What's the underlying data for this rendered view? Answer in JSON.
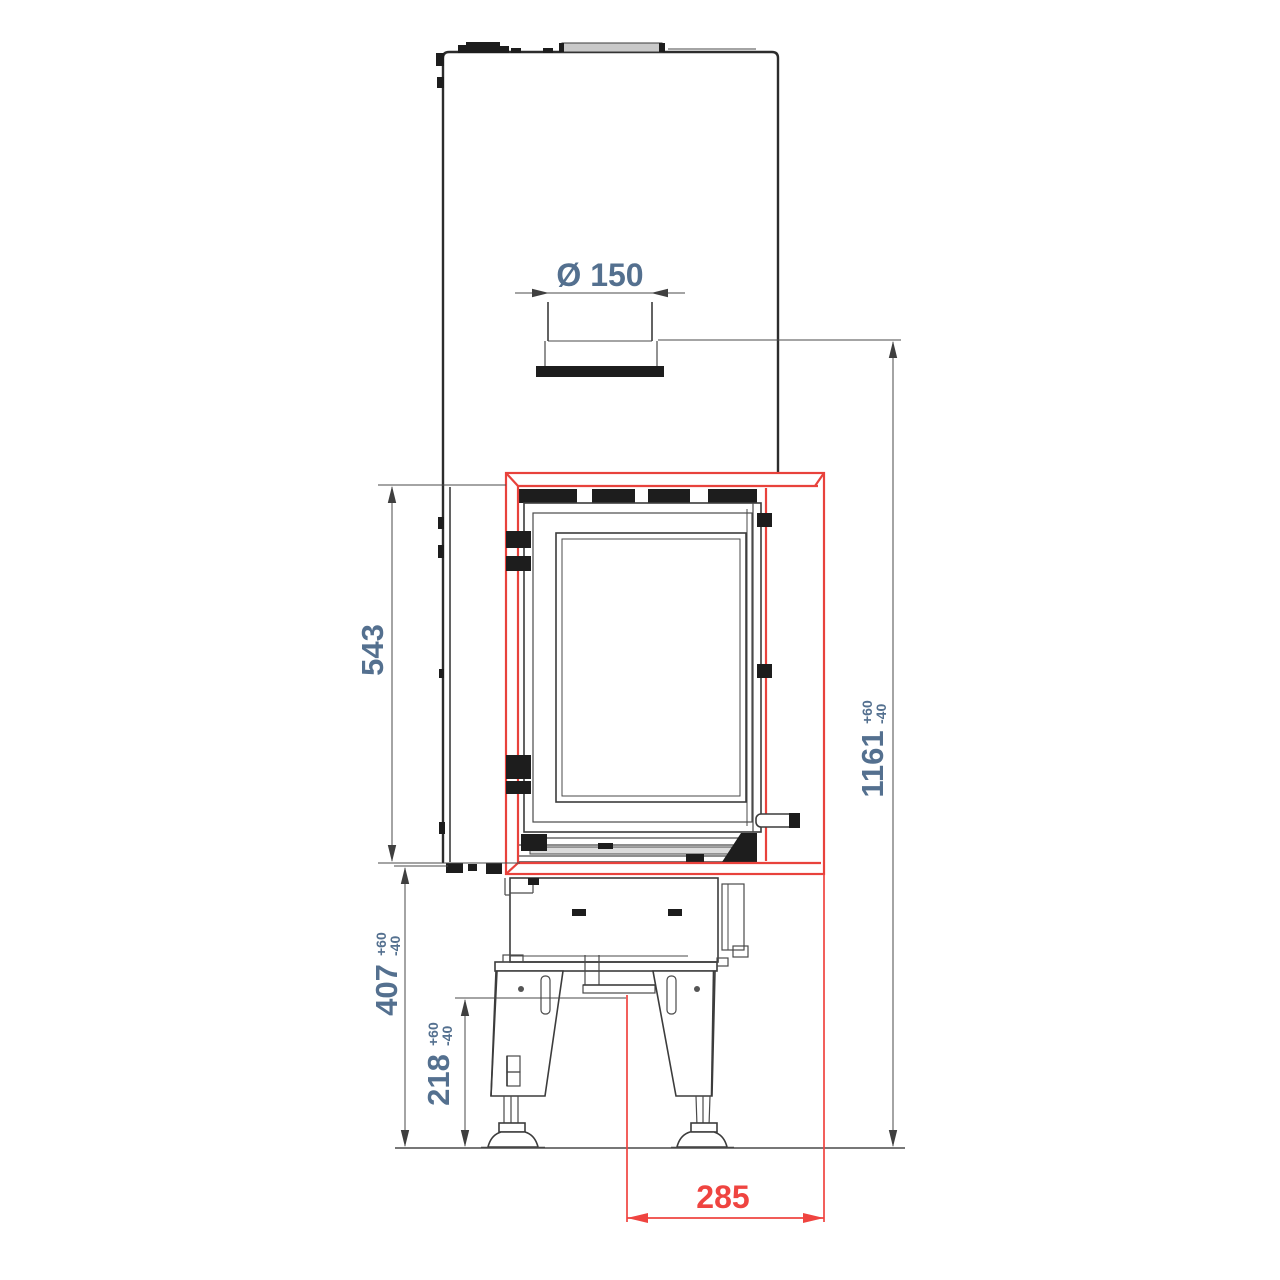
{
  "dims": {
    "flue_diameter": "Ø 150",
    "firebox_height": "543",
    "total_height": "1161",
    "total_height_tol_plus": "+60",
    "total_height_tol_minus": "-40",
    "base_height": "407",
    "base_height_tol_plus": "+60",
    "base_height_tol_minus": "-40",
    "leg_height": "218",
    "leg_height_tol_plus": "+60",
    "leg_height_tol_minus": "-40",
    "front_width": "285"
  },
  "colors": {
    "accent-red": "#e8423c",
    "dim-red": "#ef4440",
    "dim-blue": "#54708f",
    "line-dark": "#2c2c2c"
  }
}
